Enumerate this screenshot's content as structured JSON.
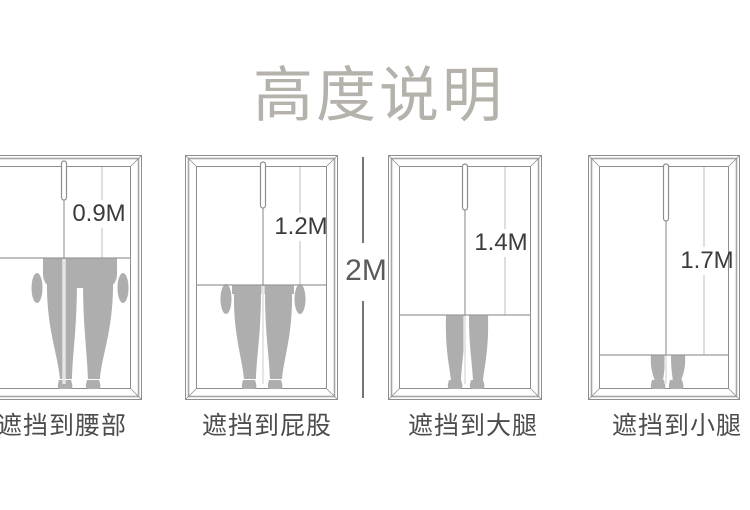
{
  "title": "高度说明",
  "dimension_label": "2M",
  "total_height_m": 2,
  "panels": [
    {
      "height_label": "0.9M",
      "height_m": 0.9,
      "caption": "遮挡到腰部",
      "coverage": "waist"
    },
    {
      "height_label": "1.2M",
      "height_m": 1.2,
      "caption": "遮挡到屁股",
      "coverage": "hip"
    },
    {
      "height_label": "1.4M",
      "height_m": 1.4,
      "caption": "遮挡到大腿",
      "coverage": "thigh"
    },
    {
      "height_label": "1.7M",
      "height_m": 1.7,
      "caption": "遮挡到小腿",
      "coverage": "calf"
    }
  ],
  "colors": {
    "background": "#ffffff",
    "title_text": "#b5b1ab",
    "frame_line": "#8e8e8e",
    "guide_line": "#9a9a9a",
    "silhouette": "#aeaeae",
    "value_text": "#3b3b3b",
    "caption_text": "#4d4d4d",
    "dimension_text": "#5a5a5a"
  }
}
